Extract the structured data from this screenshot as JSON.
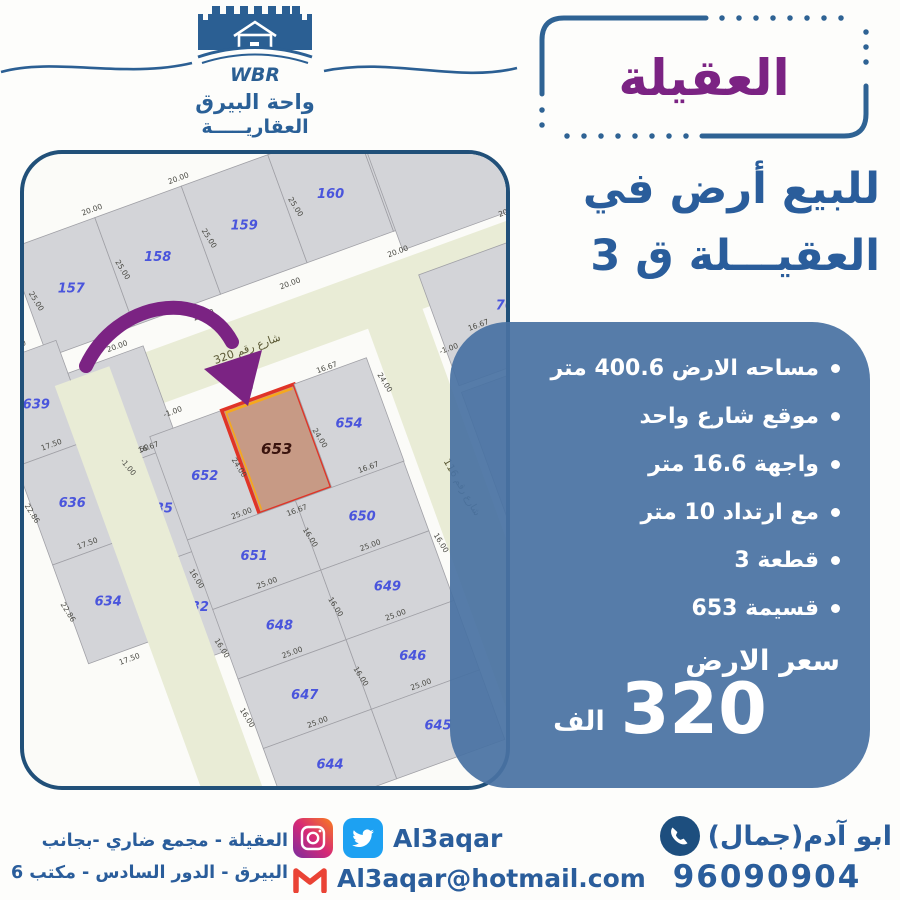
{
  "brand": {
    "wbr": "WBR",
    "name_line1": "واحة البيرق",
    "name_line2": "العقاريـــــة"
  },
  "title_box": {
    "text": "العقيلة"
  },
  "headline": {
    "line1": "للبيع أرض في",
    "line2": "العقيـــلة ق 3"
  },
  "info_panel": {
    "bullets": [
      "مساحه الارض 400.6 متر",
      "موقع شارع واحد",
      "واجهة 16.6 متر",
      "مع ارتداد 10 متر",
      "قطعة 3",
      "قسيمة 653"
    ],
    "price_label": "سعر الارض",
    "price_value": "320",
    "price_unit": "الف",
    "panel_color": "#4972a2"
  },
  "footer": {
    "address_line1": "العقيلة - مجمع ضاري -بجانب",
    "address_line2": "البيرق - الدور السادس - مكتب 6",
    "social_handle": "Al3aqar",
    "email": "Al3aqar@hotmail.com",
    "contact_name": "ابو آدم(جمال)",
    "phone": "96090904"
  },
  "map": {
    "street_fill": "#e9ecd6",
    "plot_fill": "#d3d4d8",
    "plot_stroke": "#a0a0a6",
    "num_color": "#4a55dc",
    "dim_color": "#4a4a44",
    "hl_fill": "#c79a85",
    "hl_stroke": "#e03427",
    "hl_accent": "#f6a81c",
    "hl_num": "#3a140e",
    "arrow_color": "#7b2383",
    "groups": [
      {
        "tf": "translate(220,70) rotate(-20)",
        "plots": [
          {
            "id": "157",
            "x": -230,
            "y": -57,
            "w": 92,
            "h": 115
          },
          {
            "id": "158",
            "x": -138,
            "y": -57,
            "w": 92,
            "h": 115
          },
          {
            "id": "159",
            "x": -46,
            "y": -57,
            "w": 92,
            "h": 115
          },
          {
            "id": "160",
            "x": 46,
            "y": -57,
            "w": 92,
            "h": 115
          },
          {
            "id": "161",
            "x": 138,
            "y": -57,
            "w": 92,
            "h": 115
          }
        ],
        "dims": [
          {
            "t": "20.00",
            "x": -138,
            "y": -63
          },
          {
            "t": "20.00",
            "x": -46,
            "y": -63
          },
          {
            "t": "20.00",
            "x": 46,
            "y": -63
          },
          {
            "t": "20.00",
            "x": 138,
            "y": -63
          },
          {
            "t": "20.00",
            "x": -161,
            "y": 74
          },
          {
            "t": "20.00",
            "x": -69,
            "y": 74
          },
          {
            "t": "20.00",
            "x": 23,
            "y": 74
          },
          {
            "t": "25.00",
            "x": -224,
            "y": 2,
            "r": 78
          },
          {
            "t": "25.00",
            "x": -132,
            "y": 2,
            "r": 78
          },
          {
            "t": "25.00",
            "x": -40,
            "y": 2,
            "r": 78
          },
          {
            "t": "25.00",
            "x": 52,
            "y": 2,
            "r": 78
          },
          {
            "t": "25.00",
            "x": 144,
            "y": 2,
            "r": 78
          }
        ]
      },
      {
        "tf": "translate(245,182) rotate(-20)",
        "streets": [
          {
            "x": -340,
            "y": -27,
            "w": 800,
            "h": 54
          }
        ],
        "plots": [
          {
            "id": "",
            "x": 155,
            "y": -145,
            "w": 230,
            "h": 110
          }
        ],
        "dims": [
          {
            "t": "شارع رقم 320",
            "x": -25,
            "y": 8,
            "fs": 11,
            "c": "#5a5834"
          },
          {
            "t": "20.00",
            "x": 150,
            "y": -33
          },
          {
            "t": "20.00",
            "x": 268,
            "y": -33
          }
        ]
      },
      {
        "tf": "translate(85,332) rotate(-20)",
        "plots": [
          {
            "id": "639",
            "x": -80,
            "y": -155,
            "w": 80,
            "h": 105
          },
          {
            "id": "",
            "x": 0,
            "y": -120,
            "w": 80,
            "h": 105
          },
          {
            "id": "636",
            "x": -80,
            "y": -50,
            "w": 80,
            "h": 105
          },
          {
            "id": "635",
            "x": 0,
            "y": -15,
            "w": 80,
            "h": 105
          },
          {
            "id": "634",
            "x": -80,
            "y": 55,
            "w": 80,
            "h": 105
          },
          {
            "id": "632",
            "x": 0,
            "y": 90,
            "w": 80,
            "h": 105
          }
        ],
        "dims": [
          {
            "t": "17.50",
            "x": -40,
            "y": -161
          },
          {
            "t": "17.50",
            "x": -40,
            "y": -56
          },
          {
            "t": "17.50",
            "x": -40,
            "y": 49
          },
          {
            "t": "17.50",
            "x": 40,
            "y": -21
          },
          {
            "t": "17.50",
            "x": -40,
            "y": 172
          },
          {
            "t": "22.86",
            "x": -84,
            "y": -105,
            "r": 78
          },
          {
            "t": "22.86",
            "x": -84,
            "y": 0,
            "r": 78
          },
          {
            "t": "22.86",
            "x": -4,
            "y": -70,
            "r": 78
          },
          {
            "t": "22.86",
            "x": -4,
            "y": 35,
            "r": 78
          },
          {
            "t": "22.86",
            "x": -84,
            "y": 105,
            "r": 78
          }
        ]
      },
      {
        "tf": "translate(292,403) rotate(-20)",
        "streets": [
          {
            "x": -187,
            "y": -250,
            "w": 58,
            "h": 580
          },
          {
            "x": 127,
            "y": -250,
            "w": 58,
            "h": 580
          }
        ],
        "plots": [
          {
            "id": "767",
            "x": 193,
            "y": -230,
            "w": 150,
            "h": 118
          },
          {
            "id": "",
            "x": 193,
            "y": -105,
            "w": 150,
            "h": 220
          },
          {
            "id": "652",
            "x": -115,
            "y": -170,
            "w": 77,
            "h": 110
          },
          {
            "id": "653",
            "x": -38.5,
            "y": -170,
            "w": 77,
            "h": 110,
            "hl": true
          },
          {
            "id": "654",
            "x": 38.5,
            "y": -170,
            "w": 77,
            "h": 110
          },
          {
            "id": "651",
            "x": -115,
            "y": -60,
            "w": 115,
            "h": 74
          },
          {
            "id": "650",
            "x": 0,
            "y": -60,
            "w": 115,
            "h": 74
          },
          {
            "id": "648",
            "x": -115,
            "y": 14,
            "w": 115,
            "h": 74
          },
          {
            "id": "649",
            "x": 0,
            "y": 14,
            "w": 115,
            "h": 74
          },
          {
            "id": "647",
            "x": -115,
            "y": 88,
            "w": 115,
            "h": 74
          },
          {
            "id": "646",
            "x": 0,
            "y": 88,
            "w": 115,
            "h": 74
          },
          {
            "id": "644",
            "x": -115,
            "y": 162,
            "w": 115,
            "h": 74
          },
          {
            "id": "645",
            "x": 0,
            "y": 162,
            "w": 115,
            "h": 74
          }
        ],
        "dims": [
          {
            "t": "-1.00",
            "x": -85,
            "y": -183
          },
          {
            "t": "16.67",
            "x": -10,
            "y": -180
          },
          {
            "t": "16.67",
            "x": 75,
            "y": -172
          },
          {
            "t": "16.67",
            "x": -120,
            "y": -158
          },
          {
            "t": "-1.00",
            "x": -148,
            "y": -148,
            "r": 70
          },
          {
            "t": "24.00",
            "x": -44,
            "y": -110,
            "r": 78
          },
          {
            "t": "24.00",
            "x": 42,
            "y": -110,
            "r": 78
          },
          {
            "t": "24.00",
            "x": 122,
            "y": -140,
            "r": 78
          },
          {
            "t": "16.67",
            "x": -2,
            "y": -48
          },
          {
            "t": "16.67",
            "x": 80,
            "y": -64
          },
          {
            "t": "25.00",
            "x": -55,
            "y": -64
          },
          {
            "t": "25.00",
            "x": -55,
            "y": 10
          },
          {
            "t": "25.00",
            "x": 55,
            "y": 10
          },
          {
            "t": "25.00",
            "x": -55,
            "y": 84
          },
          {
            "t": "25.00",
            "x": 55,
            "y": 84
          },
          {
            "t": "25.00",
            "x": -55,
            "y": 158
          },
          {
            "t": "25.00",
            "x": 55,
            "y": 158
          },
          {
            "t": "16.00",
            "x": -122,
            "y": -20,
            "r": 78
          },
          {
            "t": "16.00",
            "x": -1,
            "y": -20,
            "r": 78
          },
          {
            "t": "16.00",
            "x": -122,
            "y": 54,
            "r": 78
          },
          {
            "t": "16.00",
            "x": -1,
            "y": 54,
            "r": 78
          },
          {
            "t": "16.00",
            "x": -122,
            "y": 128,
            "r": 78
          },
          {
            "t": "16.00",
            "x": -1,
            "y": 128,
            "r": 78
          },
          {
            "t": "16.00",
            "x": 120,
            "y": 30,
            "r": 78
          },
          {
            "t": "-1.00",
            "x": 196,
            "y": -148
          },
          {
            "t": "16.67",
            "x": 232,
            "y": -160
          },
          {
            "t": "شارع رقم 116",
            "x": 158,
            "y": -15,
            "r": 80,
            "fs": 10,
            "c": "#5a5834"
          }
        ]
      }
    ]
  }
}
